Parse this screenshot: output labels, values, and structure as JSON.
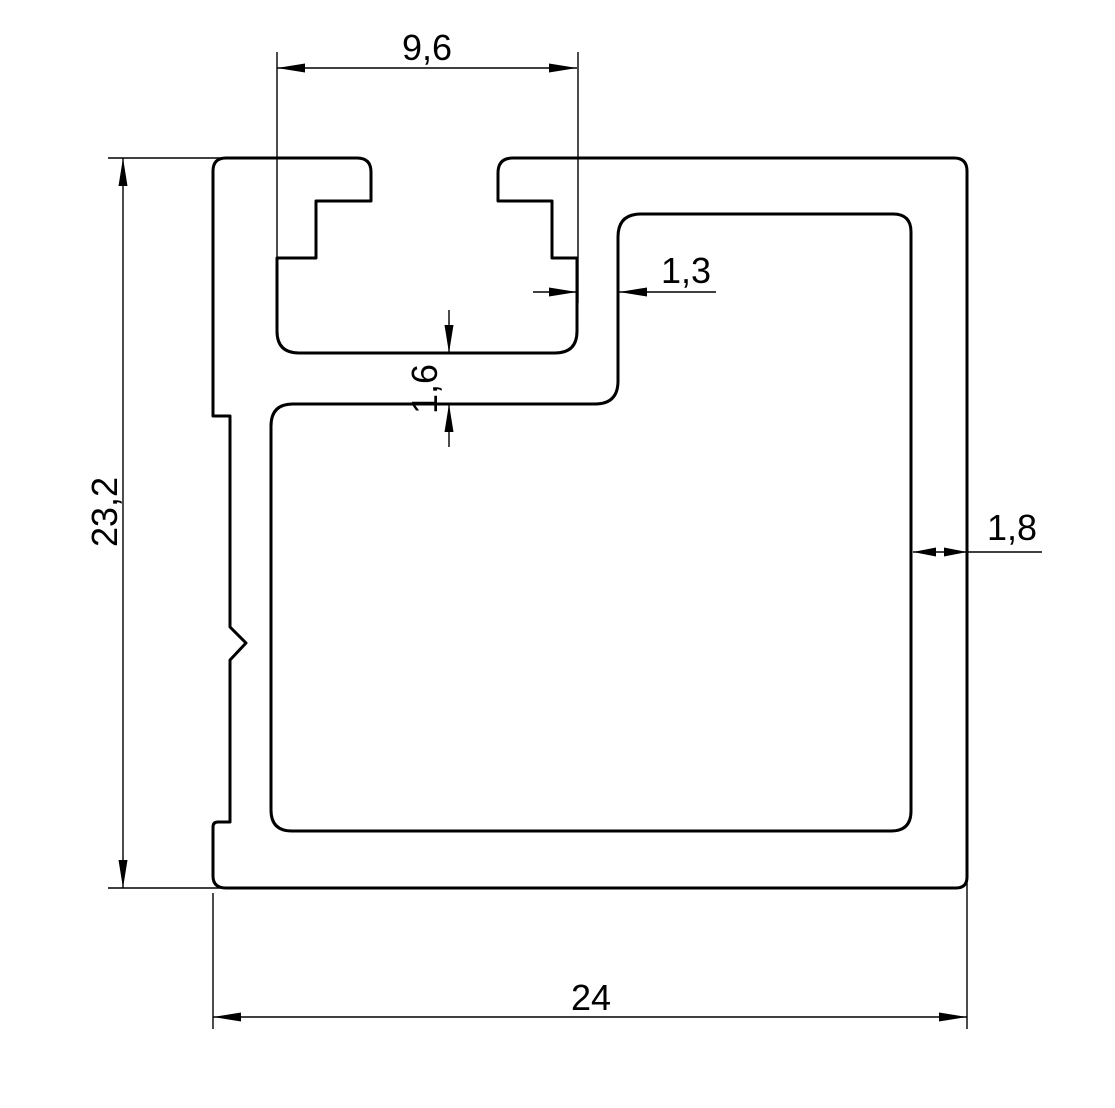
{
  "drawing": {
    "background_color": "#ffffff",
    "line_color": "#000000",
    "decimal_style": "comma",
    "dimensions": {
      "slot_width": "9,6",
      "overall_height": "23,2",
      "slot_side_wall": "1,3",
      "slot_bottom_wall": "1,6",
      "outer_wall": "1,8",
      "overall_width": "24"
    }
  }
}
